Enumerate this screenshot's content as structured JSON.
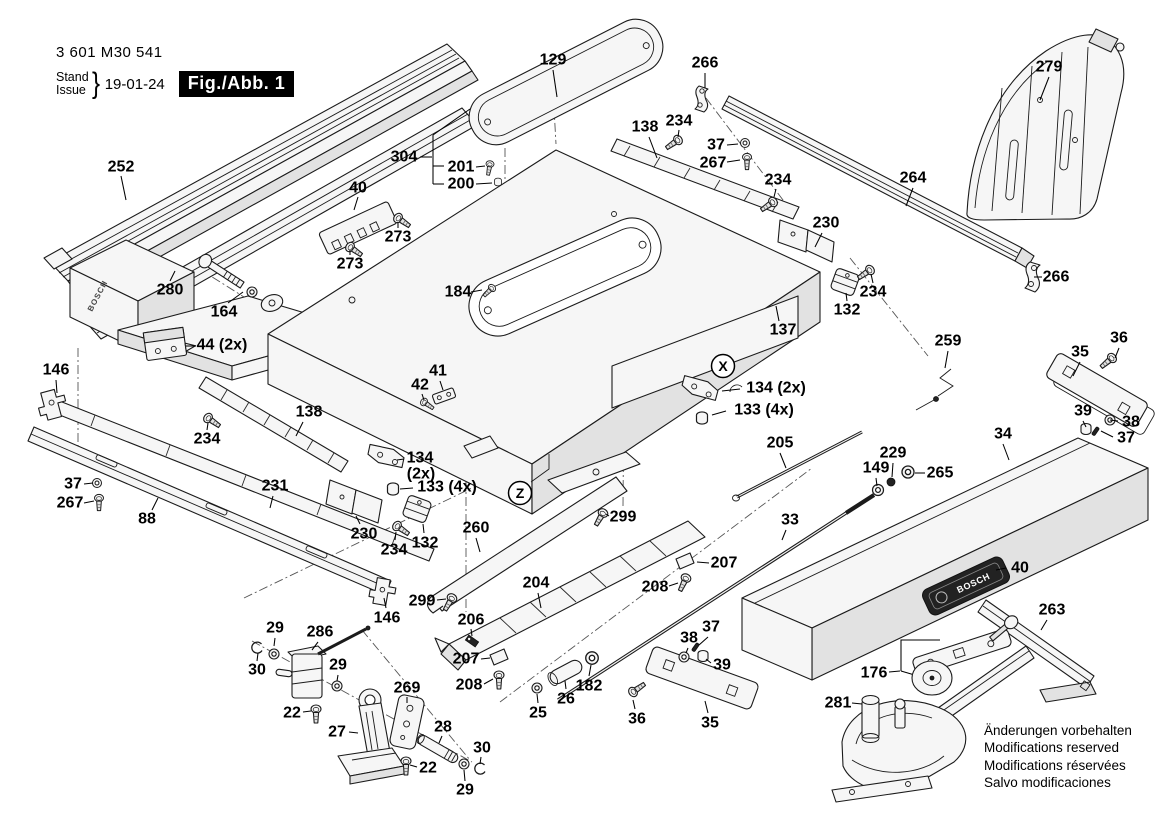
{
  "header": {
    "part_number": "3 601 M30 541",
    "stand_label": "Stand",
    "issue_label": "Issue",
    "brace": "}",
    "date": "19-01-24",
    "fig_label": "Fig./Abb. 1"
  },
  "brand": {
    "name": "BOSCH"
  },
  "colors": {
    "fig_box_bg": "#000000",
    "fig_box_text": "#ffffff",
    "line": "#1b1b1b"
  },
  "disclaimer": {
    "lines": [
      "Änderungen vorbehalten",
      "Modifications reserved",
      "Modifications réservées",
      "Salvo modificaciones"
    ]
  },
  "figure": {
    "view_markers": [
      {
        "t": "X",
        "x": 723,
        "y": 366
      },
      {
        "t": "Z",
        "x": 520,
        "y": 493
      }
    ],
    "labels": [
      {
        "t": "252",
        "x": 121,
        "y": 167,
        "line": [
          121,
          176,
          126,
          200
        ]
      },
      {
        "t": "129",
        "x": 553,
        "y": 60,
        "line": [
          553,
          70,
          557,
          97
        ]
      },
      {
        "t": "266",
        "x": 705,
        "y": 63,
        "line": [
          705,
          73,
          705,
          88
        ]
      },
      {
        "t": "279",
        "x": 1049,
        "y": 67,
        "line": [
          1049,
          77,
          1040,
          100
        ]
      },
      {
        "t": "138",
        "x": 645,
        "y": 127,
        "line": [
          649,
          137,
          657,
          158
        ]
      },
      {
        "t": "234",
        "x": 679,
        "y": 121,
        "line": [
          679,
          130,
          678,
          137
        ]
      },
      {
        "t": "37",
        "x": 716,
        "y": 145,
        "line": [
          727,
          145,
          738,
          144
        ]
      },
      {
        "t": "267",
        "x": 713,
        "y": 163,
        "line": [
          727,
          162,
          740,
          160
        ]
      },
      {
        "t": "234",
        "x": 778,
        "y": 180,
        "line": [
          776,
          189,
          774,
          197
        ]
      },
      {
        "t": "264",
        "x": 913,
        "y": 178,
        "line": [
          913,
          188,
          906,
          206
        ]
      },
      {
        "t": "304",
        "x": 404,
        "y": 157,
        "line": [
          420,
          157,
          432,
          157
        ]
      },
      {
        "t": "201",
        "x": 461,
        "y": 167,
        "line": [
          476,
          167,
          485,
          166
        ]
      },
      {
        "t": "200",
        "x": 461,
        "y": 184,
        "line": [
          476,
          184,
          492,
          183
        ]
      },
      {
        "t": "40",
        "x": 358,
        "y": 188,
        "line": [
          358,
          197,
          354,
          210
        ]
      },
      {
        "t": "273",
        "x": 398,
        "y": 237,
        "line": [
          398,
          228,
          398,
          222
        ]
      },
      {
        "t": "273",
        "x": 350,
        "y": 264,
        "line": [
          350,
          255,
          350,
          250
        ]
      },
      {
        "t": "280",
        "x": 170,
        "y": 290,
        "line": [
          170,
          281,
          175,
          271
        ]
      },
      {
        "t": "164",
        "x": 224,
        "y": 312,
        "line": [
          228,
          303,
          243,
          292
        ]
      },
      {
        "t": "44 (2x)",
        "x": 222,
        "y": 345,
        "line": [
          196,
          346,
          186,
          346
        ]
      },
      {
        "t": "184",
        "x": 458,
        "y": 292,
        "line": [
          471,
          292,
          482,
          290
        ]
      },
      {
        "t": "230",
        "x": 826,
        "y": 223,
        "line": [
          822,
          233,
          815,
          247
        ]
      },
      {
        "t": "234",
        "x": 873,
        "y": 292,
        "line": [
          873,
          283,
          871,
          274
        ]
      },
      {
        "t": "132",
        "x": 847,
        "y": 310,
        "line": [
          847,
          301,
          846,
          293
        ]
      },
      {
        "t": "137",
        "x": 783,
        "y": 330,
        "line": [
          779,
          321,
          776,
          306
        ]
      },
      {
        "t": "146",
        "x": 56,
        "y": 370,
        "line": [
          56,
          380,
          57,
          393
        ]
      },
      {
        "t": "259",
        "x": 948,
        "y": 341,
        "line": [
          948,
          351,
          945,
          368
        ]
      },
      {
        "t": "36",
        "x": 1119,
        "y": 338,
        "line": [
          1119,
          348,
          1115,
          358
        ]
      },
      {
        "t": "35",
        "x": 1080,
        "y": 352,
        "line": [
          1080,
          362,
          1073,
          376
        ]
      },
      {
        "t": "138",
        "x": 309,
        "y": 412,
        "line": [
          303,
          422,
          296,
          436
        ]
      },
      {
        "t": "234",
        "x": 207,
        "y": 439,
        "line": [
          207,
          430,
          208,
          423
        ]
      },
      {
        "t": "134 (2x)",
        "x": 776,
        "y": 388,
        "line": [
          740,
          389,
          722,
          391
        ]
      },
      {
        "t": "133 (4x)",
        "x": 764,
        "y": 410,
        "line": [
          726,
          411,
          712,
          415
        ]
      },
      {
        "t": "39",
        "x": 1083,
        "y": 411,
        "line": [
          1083,
          421,
          1086,
          427
        ]
      },
      {
        "t": "38",
        "x": 1131,
        "y": 422,
        "line": [
          1118,
          421,
          1110,
          420
        ]
      },
      {
        "t": "37",
        "x": 1126,
        "y": 438,
        "line": [
          1113,
          437,
          1101,
          431
        ]
      },
      {
        "t": "205",
        "x": 780,
        "y": 443,
        "line": [
          780,
          453,
          786,
          468
        ]
      },
      {
        "t": "34",
        "x": 1003,
        "y": 434,
        "line": [
          1003,
          444,
          1009,
          460
        ]
      },
      {
        "t": "229",
        "x": 893,
        "y": 453,
        "line": [
          893,
          463,
          892,
          477
        ]
      },
      {
        "t": "149",
        "x": 876,
        "y": 468,
        "line": [
          876,
          478,
          877,
          486
        ]
      },
      {
        "t": "265",
        "x": 940,
        "y": 473,
        "line": [
          925,
          473,
          915,
          473
        ]
      },
      {
        "t": "37",
        "x": 73,
        "y": 484,
        "line": [
          84,
          484,
          93,
          483
        ]
      },
      {
        "t": "267",
        "x": 70,
        "y": 503,
        "line": [
          84,
          503,
          94,
          501
        ]
      },
      {
        "t": "231",
        "x": 275,
        "y": 486,
        "line": [
          273,
          496,
          270,
          508
        ]
      },
      {
        "t": "88",
        "x": 147,
        "y": 519,
        "line": [
          152,
          510,
          158,
          498
        ]
      },
      {
        "t": "41",
        "x": 438,
        "y": 371,
        "line": [
          440,
          381,
          443,
          390
        ]
      },
      {
        "t": "42",
        "x": 420,
        "y": 385,
        "line": [
          422,
          394,
          424,
          400
        ]
      },
      {
        "t": "134",
        "x": 420,
        "y": 458,
        "line": [
          404,
          459,
          397,
          460
        ]
      },
      {
        "t": "(2x)",
        "x": 421,
        "y": 474
      },
      {
        "t": "133 (4x)",
        "x": 447,
        "y": 487,
        "line": [
          413,
          488,
          400,
          489
        ]
      },
      {
        "t": "230",
        "x": 364,
        "y": 534,
        "line": [
          360,
          524,
          356,
          516
        ]
      },
      {
        "t": "234",
        "x": 394,
        "y": 550,
        "line": [
          395,
          540,
          396,
          532
        ]
      },
      {
        "t": "132",
        "x": 425,
        "y": 543,
        "line": [
          424,
          533,
          423,
          524
        ]
      },
      {
        "t": "260",
        "x": 476,
        "y": 528,
        "line": [
          476,
          538,
          480,
          552
        ]
      },
      {
        "t": "299",
        "x": 422,
        "y": 601,
        "line": [
          437,
          600,
          446,
          599
        ]
      },
      {
        "t": "299",
        "x": 623,
        "y": 517,
        "line": [
          609,
          516,
          606,
          514
        ]
      },
      {
        "t": "33",
        "x": 790,
        "y": 520,
        "line": [
          786,
          530,
          782,
          540
        ]
      },
      {
        "t": "146",
        "x": 387,
        "y": 618,
        "line": [
          386,
          608,
          384,
          598
        ]
      },
      {
        "t": "204",
        "x": 536,
        "y": 583,
        "line": [
          538,
          593,
          541,
          608
        ]
      },
      {
        "t": "206",
        "x": 471,
        "y": 620,
        "line": [
          471,
          629,
          472,
          636
        ]
      },
      {
        "t": "207",
        "x": 466,
        "y": 659,
        "line": [
          481,
          659,
          490,
          658
        ]
      },
      {
        "t": "208",
        "x": 469,
        "y": 685,
        "line": [
          484,
          684,
          493,
          679
        ]
      },
      {
        "t": "207",
        "x": 724,
        "y": 563,
        "line": [
          709,
          563,
          697,
          562
        ]
      },
      {
        "t": "208",
        "x": 655,
        "y": 587,
        "line": [
          669,
          586,
          678,
          583
        ]
      },
      {
        "t": "29",
        "x": 275,
        "y": 628,
        "line": [
          275,
          638,
          274,
          646
        ]
      },
      {
        "t": "286",
        "x": 320,
        "y": 632,
        "line": [
          318,
          642,
          312,
          650
        ]
      },
      {
        "t": "30",
        "x": 257,
        "y": 670,
        "line": [
          257,
          661,
          258,
          653
        ]
      },
      {
        "t": "29",
        "x": 338,
        "y": 665,
        "line": [
          338,
          675,
          337,
          681
        ]
      },
      {
        "t": "22",
        "x": 292,
        "y": 713,
        "line": [
          303,
          712,
          311,
          711
        ]
      },
      {
        "t": "27",
        "x": 337,
        "y": 732,
        "line": [
          349,
          732,
          358,
          733
        ]
      },
      {
        "t": "269",
        "x": 407,
        "y": 688,
        "line": [
          407,
          697,
          407,
          703
        ]
      },
      {
        "t": "28",
        "x": 443,
        "y": 727,
        "line": [
          442,
          736,
          439,
          743
        ]
      },
      {
        "t": "22",
        "x": 428,
        "y": 768,
        "line": [
          417,
          767,
          410,
          765
        ]
      },
      {
        "t": "30",
        "x": 482,
        "y": 748,
        "line": [
          481,
          757,
          480,
          764
        ]
      },
      {
        "t": "29",
        "x": 465,
        "y": 790,
        "line": [
          465,
          781,
          464,
          770
        ]
      },
      {
        "t": "25",
        "x": 538,
        "y": 713,
        "line": [
          538,
          703,
          537,
          694
        ]
      },
      {
        "t": "26",
        "x": 566,
        "y": 699,
        "line": [
          566,
          689,
          565,
          681
        ]
      },
      {
        "t": "182",
        "x": 589,
        "y": 686,
        "line": [
          589,
          676,
          591,
          665
        ]
      },
      {
        "t": "36",
        "x": 637,
        "y": 719,
        "line": [
          635,
          709,
          633,
          700
        ]
      },
      {
        "t": "35",
        "x": 710,
        "y": 723,
        "line": [
          708,
          713,
          705,
          701
        ]
      },
      {
        "t": "38",
        "x": 689,
        "y": 638,
        "line": [
          688,
          648,
          686,
          653
        ]
      },
      {
        "t": "37",
        "x": 711,
        "y": 627,
        "line": [
          708,
          637,
          699,
          645
        ]
      },
      {
        "t": "39",
        "x": 722,
        "y": 665,
        "line": [
          711,
          663,
          706,
          659
        ]
      },
      {
        "t": "176",
        "x": 874,
        "y": 673,
        "line": [
          889,
          672,
          900,
          671
        ]
      },
      {
        "t": "281",
        "x": 838,
        "y": 703,
        "line": [
          852,
          703,
          862,
          704
        ]
      },
      {
        "t": "263",
        "x": 1052,
        "y": 610,
        "line": [
          1047,
          620,
          1041,
          630
        ]
      },
      {
        "t": "40",
        "x": 1020,
        "y": 568,
        "line": [
          1006,
          568,
          996,
          570
        ]
      },
      {
        "t": "266",
        "x": 1056,
        "y": 277,
        "line": [
          1042,
          277,
          1034,
          277
        ]
      }
    ]
  }
}
